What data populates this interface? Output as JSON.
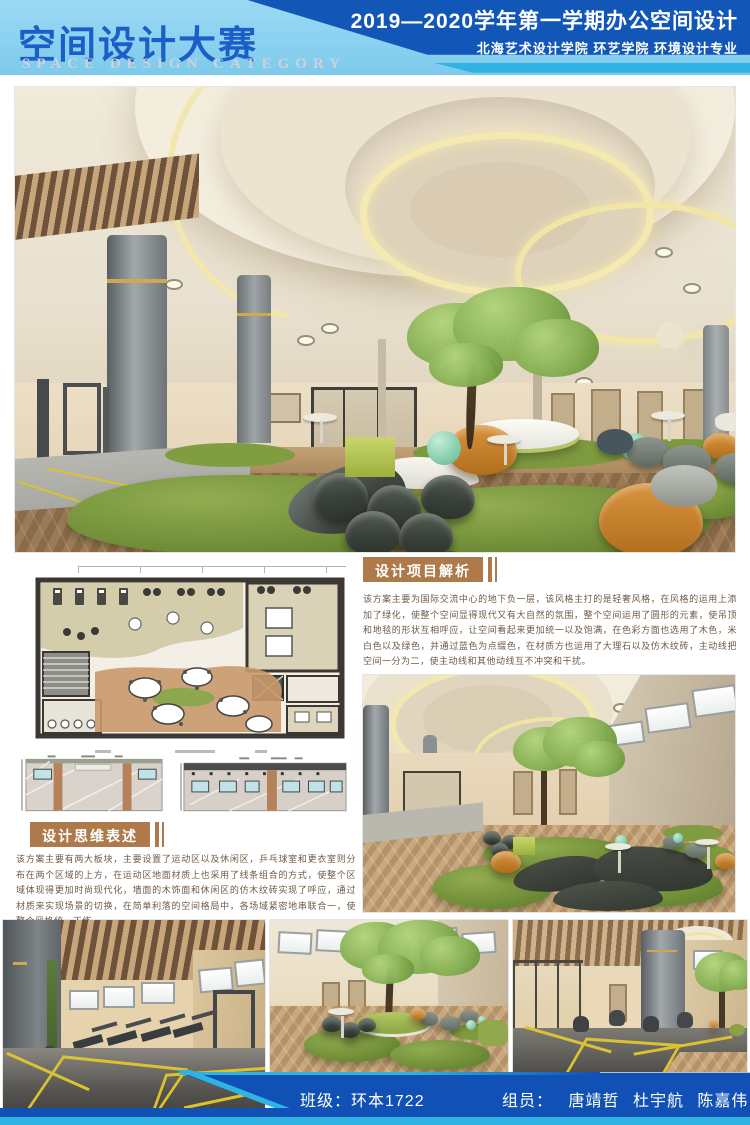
{
  "header": {
    "title": "空间设计大赛",
    "subtitle": "SPACE DESIGN CATEGORY",
    "term_line": "2019—2020学年第一学期办公空间设计",
    "school_line": "北海艺术设计学院 环艺学院 环境设计专业"
  },
  "sections": {
    "analysis": {
      "heading": "设计项目解析",
      "body": "该方案主要为国际交流中心的地下负一层，该风格主打的是轻奢风格，在风格的运用上添加了绿化，使整个空间显得现代又有大自然的氛围，整个空间运用了圆形的元素，使吊顶和地毯的形状互相呼应，让空间看起来更加统一以及饱满，在色彩方面也选用了木色，米白色以及绿色，并通过蓝色为点缀色，在材质方也运用了大理石以及仿木纹砖，主动线把空间一分为二，使主动线和其他动线互不冲突和干扰。"
    },
    "concept": {
      "heading": "设计思维表述",
      "body": "该方案主要有两大板块，主要设置了运动区以及休闲区，乒乓球室和更衣室则分布在两个区域的上方，在运动区地面材质上也采用了线条组合的方式，使整个区域体现得更加时尚现代化，墙面的木饰面和休闲区的仿木纹砖实现了呼应，通过材质来实现场景的切换，在简单利落的空间格局中，各场域紧密地串联合一，使整个风格统一干练。"
    }
  },
  "footer": {
    "class_label": "班级：环本1722",
    "members_label": "组员：",
    "members": [
      "唐靖哲",
      "杜宇航",
      "陈嘉伟",
      "伍毅"
    ]
  },
  "icons": {
    "floor_plan": "floor-plan-drawing",
    "elevations": "wall-elevation-drawings"
  },
  "colors": {
    "header_light": "#9bd9f5",
    "header_dark": "#1257b7",
    "accent_cyan": "#2fb3e3",
    "title_blue": "#1b5ec8",
    "heading_brown": "#ae7a4c",
    "body_text": "#6f5a45",
    "footer_blue": "#1150b4",
    "grass_green": "#7c9c40",
    "wood_brown": "#9b7a56",
    "marble_gray": "#8d9396",
    "ceiling_cream": "#f0ead9"
  }
}
